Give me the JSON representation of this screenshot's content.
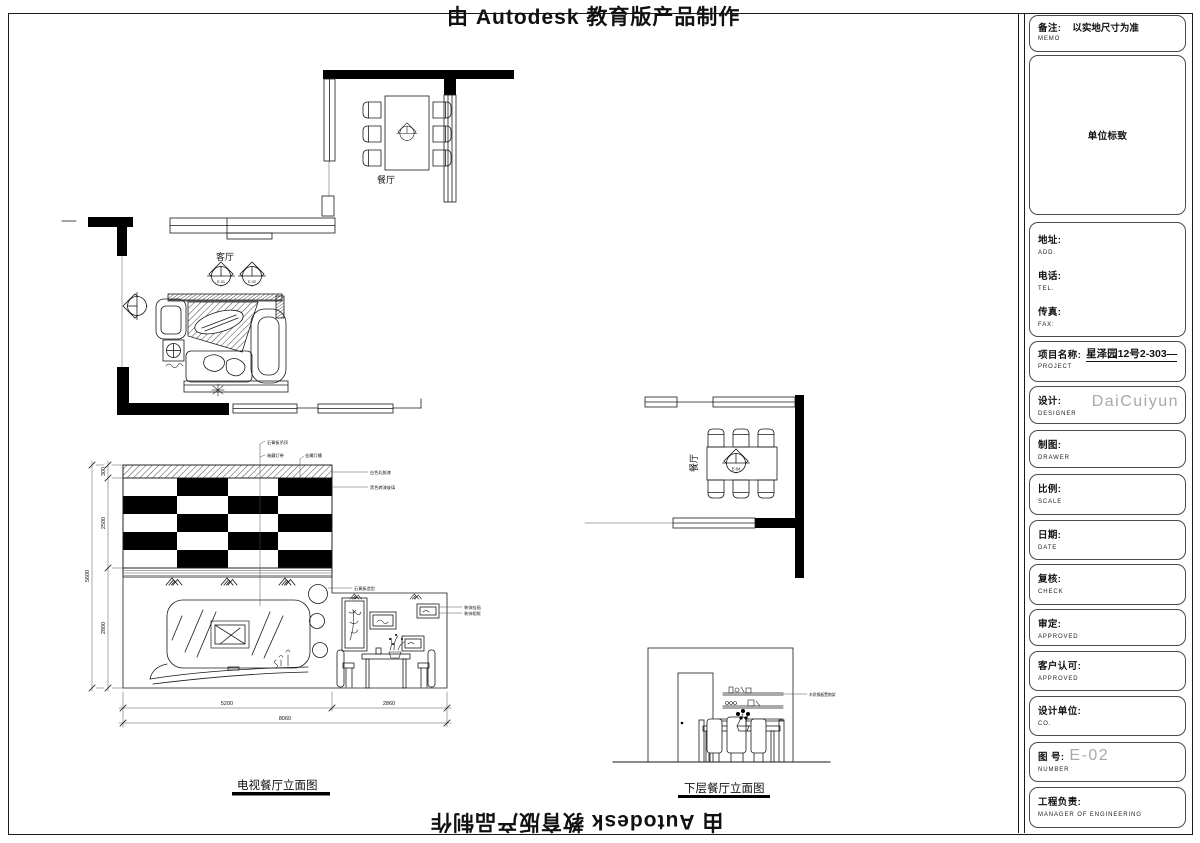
{
  "watermark": {
    "top": "由 Autodesk 教育版产品制作",
    "bottom": "由 Autodesk 教育版产品制作"
  },
  "titleblock": {
    "memo": {
      "label": "备注:",
      "sub": "MEMO",
      "value": "以实地尺寸为准"
    },
    "logo": {
      "value": "单位标致"
    },
    "contact": {
      "addr_label": "地址:",
      "addr_sub": "ADD.",
      "tel_label": "电话:",
      "tel_sub": "TEL.",
      "fax_label": "传真:",
      "fax_sub": "FAX:"
    },
    "project": {
      "label": "项目名称:",
      "sub": "PROJECT",
      "value": "星泽园12号2-303—"
    },
    "designer": {
      "label": "设计:",
      "sub": "DESIGNER",
      "value": "DaiCuiyun"
    },
    "drawer": {
      "label": "制图:",
      "sub": "DRAWER"
    },
    "scale": {
      "label": "比例:",
      "sub": "SCALE"
    },
    "date": {
      "label": "日期:",
      "sub": "DATE"
    },
    "check": {
      "label": "复核:",
      "sub": "CHECK"
    },
    "approve": {
      "label": "审定:",
      "sub": "APPROVED"
    },
    "client": {
      "label": "客户认可:",
      "sub": "APPROVED"
    },
    "company": {
      "label": "设计单位:",
      "sub": "CO."
    },
    "number": {
      "label": "图  号:",
      "sub": "NUMBER",
      "value": "E-02"
    },
    "manager": {
      "label": "工程负责:",
      "sub": "MANAGER OF ENGINEERING"
    }
  },
  "plans": {
    "dining_top": {
      "label": "餐厅"
    },
    "living": {
      "label": "客厅",
      "marker1": "E-01",
      "marker2": "E-02"
    },
    "dining_right": {
      "label": "餐厅",
      "marker": "E-04"
    }
  },
  "elev_tv": {
    "title": "电视餐厅立面图",
    "dims": {
      "h1": "300",
      "h2": "2500",
      "h3": "2800",
      "total_h": "5600",
      "w1": "5200",
      "w2": "2860",
      "total_w": "8060"
    },
    "ann": {
      "a1": "石膏板吊顶",
      "a2": "暗藏灯带",
      "a3": "金属灯槽",
      "a4": "白色乳胶漆",
      "a5": "黑色烤漆玻璃",
      "a6": "石膏板造型",
      "a7": "装饰挂画",
      "a8": "装饰相框"
    }
  },
  "elev_lower": {
    "title": "下层餐厅立面图",
    "ann": "木质搁板置物架"
  }
}
